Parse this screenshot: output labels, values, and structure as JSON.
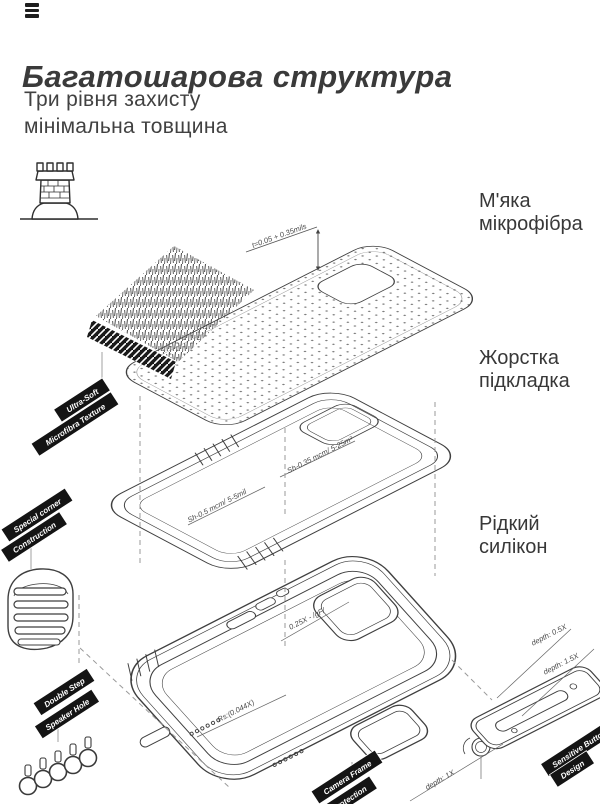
{
  "header": {
    "title": "Багатошарова структура",
    "subtitle_line1": "Три рівня захисту",
    "subtitle_line2": "мінімальна товщина"
  },
  "layer_labels": {
    "microfiber_line1": "М'яка",
    "microfiber_line2": "мікрофібра",
    "lining_line1": "Жорстка",
    "lining_line2": "підкладка",
    "silicone_line1": "Рідкий",
    "silicone_line2": "силікон"
  },
  "ribbons": {
    "ultra_soft": "Ultra-Soft",
    "microfibra_texture": "Microfibra Texture",
    "special_corner": "Special corner",
    "construction": "Construction",
    "double_step": "Double Step",
    "speaker_hole": "Speaker Hole",
    "camera_frame": "Camera Frame",
    "protection": "Protection",
    "sensitive_button": "Sensitive Button",
    "design": "Design"
  },
  "annotations": {
    "microfiber_thickness": "t=0.05 + 0.35mils",
    "lining_upper": "Sh-0.35 mcm/ 5-25m²",
    "lining_lower": "Sh-0.5 mcm/ 5-5mil",
    "case_wall": "0.25X - /gF/",
    "case_radius": "Rs:(0.044X)",
    "button_depth_small": "depth: 0.5X",
    "button_depth_large": "depth: 1.5X",
    "camera_depth": "depth: 1X"
  },
  "colors": {
    "ink": "#3a3a3a",
    "line_art": "#3f3f3f",
    "ribbon_bg": "#141414",
    "ribbon_text": "#ffffff",
    "background": "#ffffff"
  }
}
